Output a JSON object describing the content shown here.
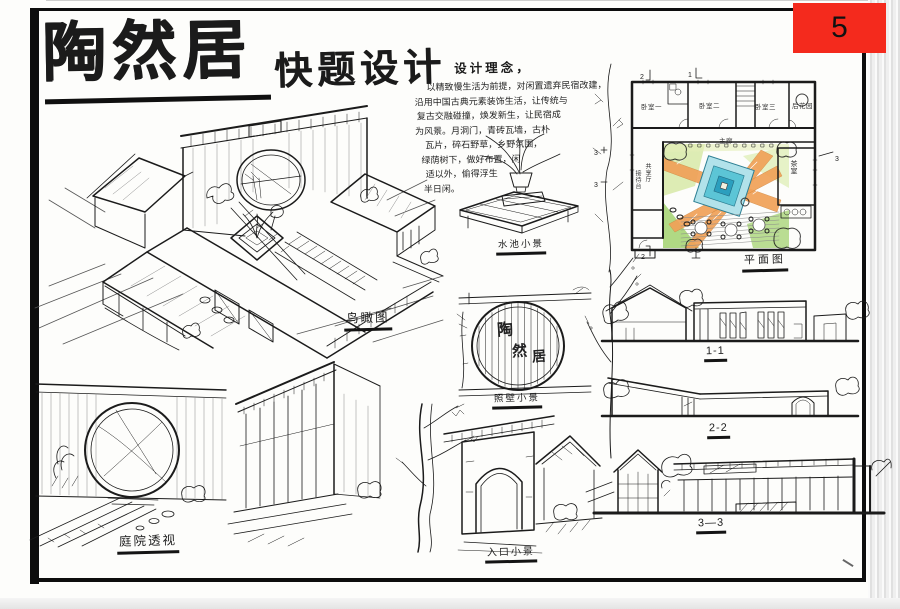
{
  "sheet": {
    "number": "5"
  },
  "title": {
    "main": "陶然居",
    "subtitle": "快题设计"
  },
  "concept": {
    "heading": "设计理念，",
    "lines": [
      "以精致慢生活为前提，对闲置遗弃民宿改建，",
      "沿用中国古典元素装饰生活，让传统与",
      "复古交融碰撞，焕发新生，让民宿成",
      "为风景。月洞门，青砖瓦墙，古朴",
      "瓦片，碎石野草，乡野氛围，",
      "绿荫树下，做好布置，闲",
      "适以外，偷得浮生",
      "半日闲。"
    ]
  },
  "drawings": {
    "axonometric": {
      "label": "鸟瞰图"
    },
    "water_feature": {
      "label": "水池小景"
    },
    "screen_wall": {
      "label": "照壁小景",
      "inscription": [
        "陶",
        "然",
        "居"
      ]
    },
    "plan": {
      "label": "平面图",
      "rooms": [
        "卧室一",
        "卧室二",
        "卧室三",
        "后花园",
        "主廊",
        "茶室",
        "共享厅",
        "接待台"
      ],
      "section_marks": [
        "1",
        "2",
        "3"
      ]
    },
    "section_1": {
      "label": "1-1"
    },
    "section_2": {
      "label": "2-2"
    },
    "section_3": {
      "label": "3—3"
    },
    "courtyard": {
      "label": "庭院透视"
    },
    "entrance": {
      "label": "入口小景"
    }
  },
  "palette": {
    "badge_red": "#f42a1d",
    "ink": "#1b1b1b",
    "path_orange": "#f0a158",
    "pool_teal": "#5cc5d6",
    "pool_deep": "#2b9fbe",
    "green_light": "#d2e69c",
    "green_mid": "#9ccf66",
    "green_dark": "#55a843",
    "paper": "#fdfdfb"
  }
}
